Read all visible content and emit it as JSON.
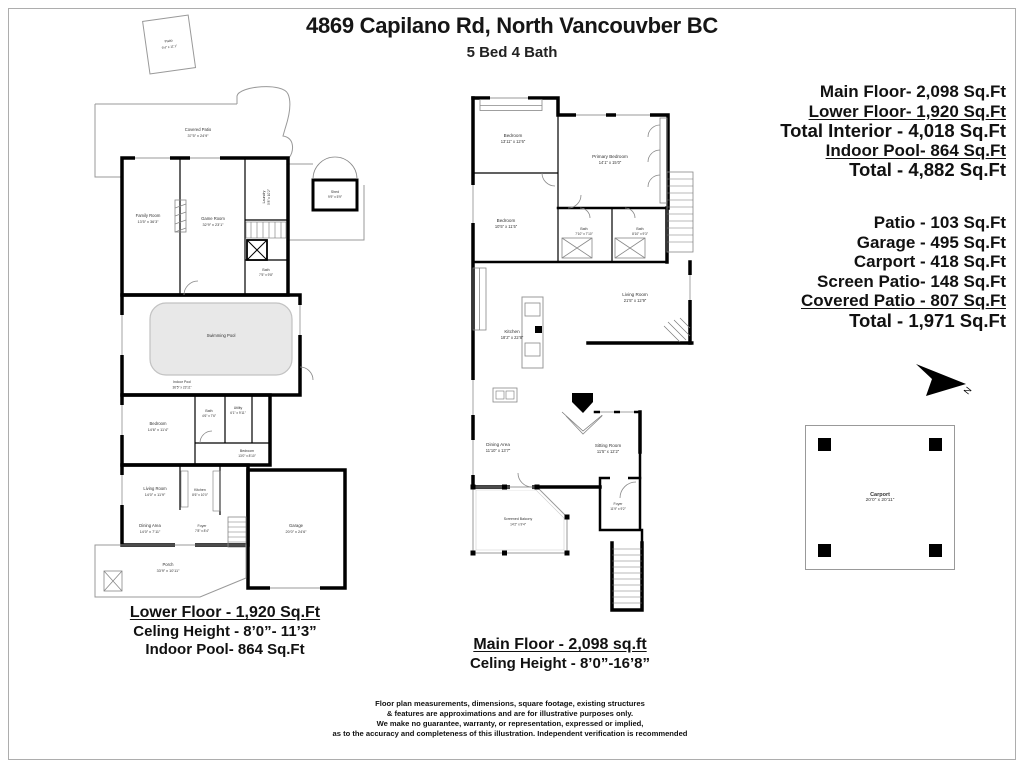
{
  "header": {
    "title": "4869 Capilano Rd, North Vancouvber BC",
    "subtitle": "5 Bed 4 Bath"
  },
  "interior_summary": {
    "lines": [
      "Main Floor- 2,098 Sq.Ft",
      "Lower Floor- 1,920 Sq.Ft",
      "Total Interior - 4,018 Sq.Ft",
      "Indoor Pool- 864 Sq.Ft",
      "Total - 4,882 Sq.Ft"
    ]
  },
  "exterior_summary": {
    "lines": [
      "Patio - 103 Sq.Ft",
      "Garage - 495 Sq.Ft",
      "Carport - 418 Sq.Ft",
      "Screen Patio- 148 Sq.Ft",
      "Covered Patio - 807 Sq.Ft",
      "Total - 1,971 Sq.Ft"
    ]
  },
  "lower_floor": {
    "caption": {
      "line1": "Lower Floor - 1,920 Sq.Ft",
      "line2": "Celing Height - 8’0”- 11’3”",
      "line3": "Indoor Pool- 864 Sq.Ft"
    },
    "rooms": {
      "patio": {
        "name": "Patio",
        "dims": "9’4” x 11’1”"
      },
      "covered_patio": {
        "name": "Covered Patio",
        "dims": "37’5” x 24’9”"
      },
      "family_room": {
        "name": "Family Room",
        "dims": "13’5” x 36’3”"
      },
      "game_room": {
        "name": "Game Room",
        "dims": "32’9” x 23’1”"
      },
      "laundry": {
        "name": "Laundry",
        "dims": "5’8” x 10’2”"
      },
      "shed": {
        "name": "Shed",
        "dims": "9’9” x 5’9”"
      },
      "bath_upper": {
        "name": "Bath",
        "dims": "7’5” x 9’8”"
      },
      "swimming_pool": {
        "name": "Swimming Pool"
      },
      "indoor_pool": {
        "name": "Indoor Pool",
        "dims": "36’5” x 23’11”"
      },
      "bedroom_left": {
        "name": "Bedroom",
        "dims": "14’6” x 11’4”"
      },
      "bath_mid": {
        "name": "Bath",
        "dims": "4’6” x 7’6”"
      },
      "utility": {
        "name": "Utility",
        "dims": "6’1” x 9’11”"
      },
      "bedroom_right": {
        "name": "Bedroom",
        "dims": "13’0” x 8’10”"
      },
      "living_room": {
        "name": "Living Room",
        "dims": "14’0” x 11’9”"
      },
      "kitchen": {
        "name": "Kitchen",
        "dims": "8’6” x 10’0”"
      },
      "dining_area": {
        "name": "Dining Area",
        "dims": "14’0” x 7’11”"
      },
      "foyer": {
        "name": "Foyer",
        "dims": "7’8” x 8’4”"
      },
      "porch": {
        "name": "Porch",
        "dims": "33’9” x 10’11”"
      },
      "garage": {
        "name": "Garage",
        "dims": "20’0” x 24’6”"
      }
    }
  },
  "main_floor": {
    "caption": {
      "line1": "Main Floor - 2,098 sq.ft",
      "line2": "Celing Height - 8’0”-16’8”"
    },
    "rooms": {
      "bedroom_top": {
        "name": "Bedroom",
        "dims": "13’11” x 12’6”"
      },
      "primary_bedroom": {
        "name": "Primary Bedroom",
        "dims": "14’1” x 15’0”"
      },
      "bedroom_left": {
        "name": "Bedroom",
        "dims": "10’5” x 11’5”"
      },
      "bath_left": {
        "name": "Bath",
        "dims": "7’10” x 7’10”"
      },
      "bath_right": {
        "name": "Bath",
        "dims": "8’10” x 9’3”"
      },
      "living_room": {
        "name": "Living Room",
        "dims": "21’5” x 12’9”"
      },
      "kitchen": {
        "name": "Kitchen",
        "dims": "18’2” x 22’8”"
      },
      "dining_area": {
        "name": "Dining Area",
        "dims": "11’10” x 13’7”"
      },
      "sitting_room": {
        "name": "Sitting Room",
        "dims": "11’5” x 12’2”"
      },
      "screened_balcony": {
        "name": "Screened Balcony",
        "dims": "14’2” x 9’4”"
      },
      "foyer": {
        "name": "Foyer",
        "dims": "11’9” x 9’2”"
      }
    }
  },
  "carport": {
    "name": "Carport",
    "dims": "20’0” x 20’11”"
  },
  "compass": {
    "label": "N"
  },
  "disclaimer": {
    "lines": [
      "Floor plan measurements, dimensions, square footage, existing structures",
      "& features are approximations and are for illustrative purposes only.",
      "We make no guarantee, warranty, or representation, expressed or implied,",
      "as to the accuracy and completeness of this illustration. Independent verification is recommended"
    ]
  }
}
